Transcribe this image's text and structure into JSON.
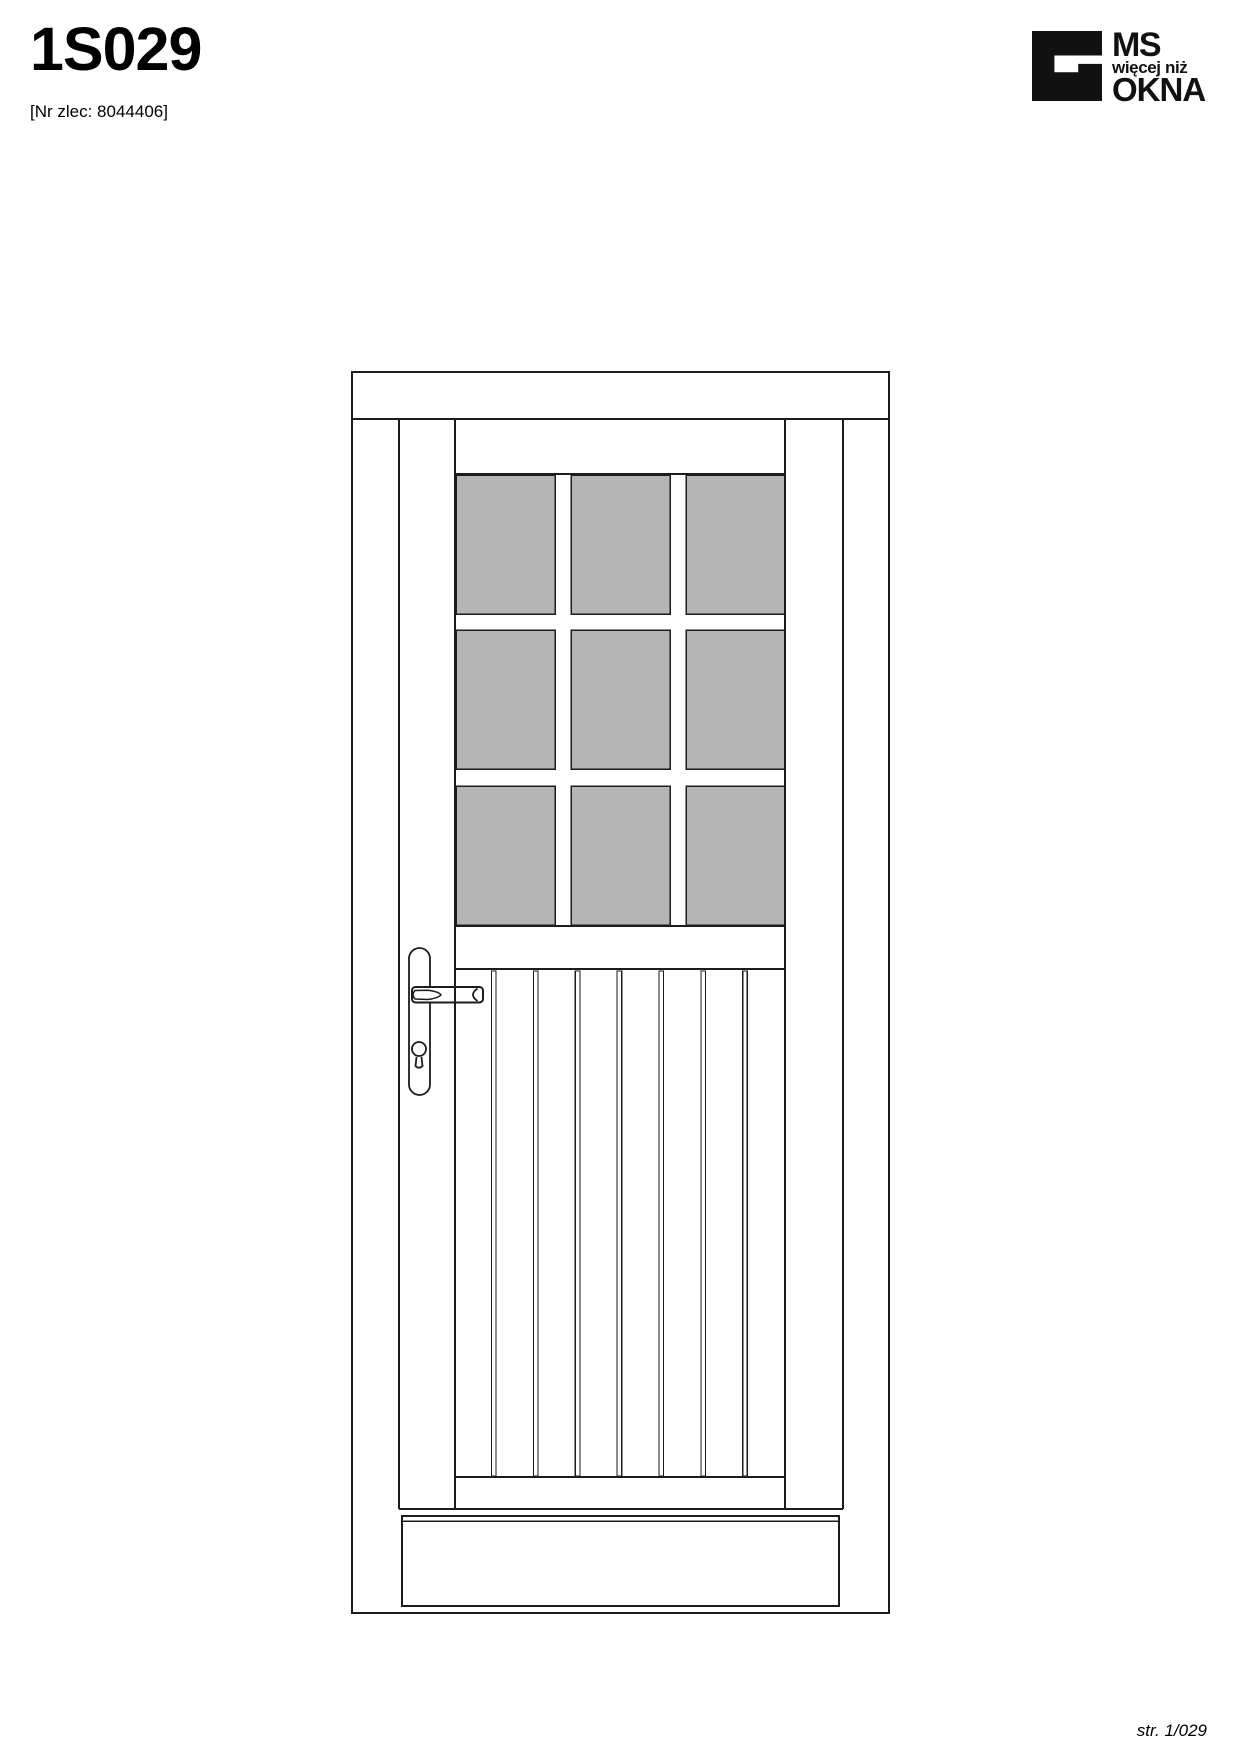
{
  "page": {
    "title": "1S029",
    "order_ref": "[Nr zlec: 8044406]",
    "footer": "str. 1/029"
  },
  "logo": {
    "line1": "MS",
    "line2": "więcej niż",
    "line3": "OKNA"
  },
  "drawing": {
    "type": "door-elevation-technical-drawing",
    "glazing_rows": 3,
    "glazing_cols": 3,
    "plank_grooves": 7
  },
  "colors": {
    "line": "#1c1c1c",
    "glass": "#b5b5b5",
    "logo": "#111111",
    "background": "#ffffff"
  }
}
